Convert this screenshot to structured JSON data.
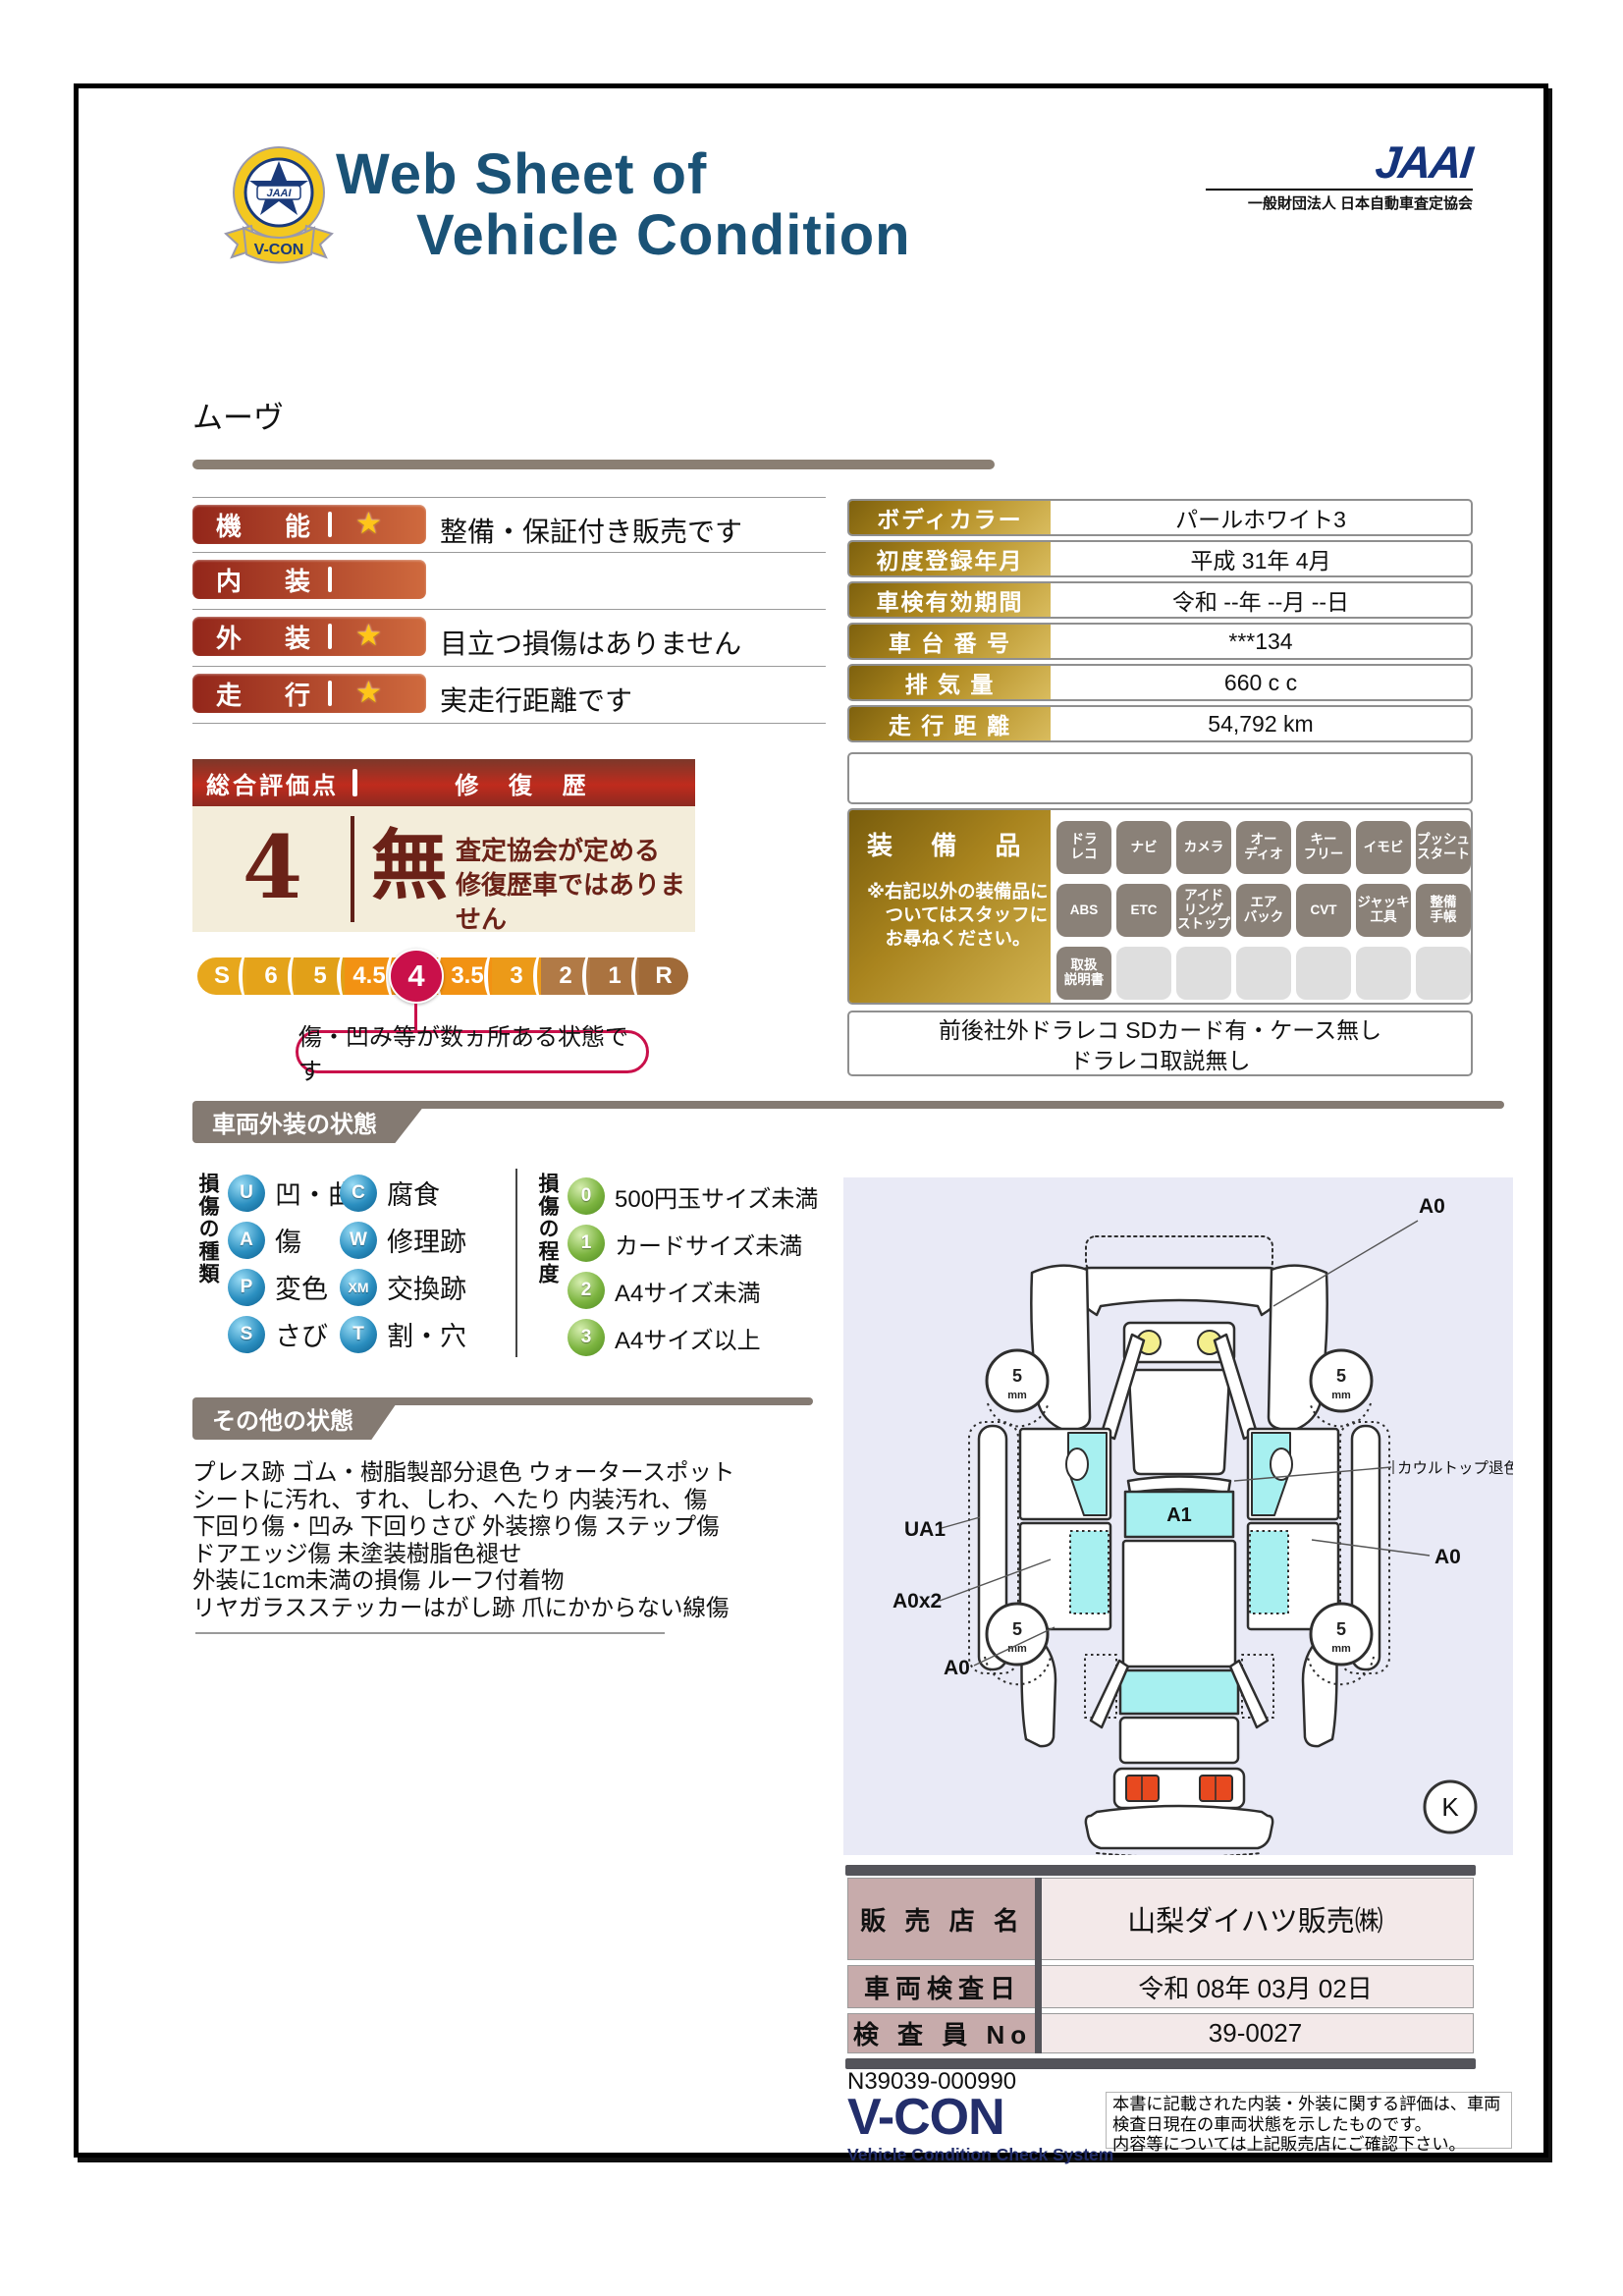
{
  "header": {
    "title_line1": "Web Sheet of",
    "title_line2": "Vehicle Condition",
    "emblem": {
      "badge_text": "JAAI",
      "ribbon_text": "V-CON"
    },
    "jaai_logo": "JAAI",
    "jaai_org": "一般財団法人 日本自動車査定協会"
  },
  "vehicle_name": "ムーヴ",
  "ratings": {
    "rows": [
      {
        "label": "機能",
        "star": true,
        "note": "整備・保証付き販売です"
      },
      {
        "label": "内装",
        "star": false,
        "note": ""
      },
      {
        "label": "外装",
        "star": true,
        "note": "目立つ損傷はありません"
      },
      {
        "label": "走行",
        "star": true,
        "note": "実走行距離です"
      }
    ]
  },
  "overall": {
    "score_header": "総合評価点",
    "repair_header": "修 復 歴",
    "score": "4",
    "repair_value": "無",
    "repair_note_line1": "査定協会が定める",
    "repair_note_line2": "修復歴車ではありません",
    "scale": [
      "S",
      "6",
      "5",
      "4.5",
      "4",
      "3.5",
      "3",
      "2",
      "1",
      "R"
    ],
    "scale_colors": [
      "#e7a71c",
      "#e4a31a",
      "#e1a018",
      "#f29213",
      "#ef9013",
      "#f29213",
      "#ec9a18",
      "#b17a46",
      "#aa7340",
      "#a06a38"
    ],
    "selected": "4",
    "bubble": "傷・凹み等が数ヵ所ある状態です"
  },
  "info_table": {
    "rows": [
      {
        "label": "ボディカラー",
        "value": "パールホワイト3"
      },
      {
        "label": "初度登録年月",
        "value": "平成 31年 4月"
      },
      {
        "label": "車検有効期間",
        "value": "令和 --年 --月 --日"
      },
      {
        "label": "車 台 番 号",
        "value": "***134"
      },
      {
        "label": "排  気  量",
        "value": "660 c c"
      },
      {
        "label": "走 行 距 離",
        "value": "54,792 km"
      }
    ]
  },
  "equipment": {
    "title": "装 備 品",
    "note_lines": [
      "※右記以外の装備品に",
      "　ついてはスタッフに",
      "　お尋ねください。"
    ],
    "badges": [
      [
        "ドラ",
        "レコ"
      ],
      [
        "ナビ"
      ],
      [
        "カメラ"
      ],
      [
        "オー",
        "ディオ"
      ],
      [
        "キー",
        "フリー"
      ],
      [
        "イモビ"
      ],
      [
        "プッシュ",
        "スタート"
      ],
      [
        "ABS"
      ],
      [
        "ETC"
      ],
      [
        "アイド",
        "リング",
        "ストップ"
      ],
      [
        "エア",
        "バック"
      ],
      [
        "CVT"
      ],
      [
        "ジャッキ",
        "工具"
      ],
      [
        "整備",
        "手帳"
      ],
      [
        "取扱",
        "説明書"
      ]
    ],
    "empty_count": 6,
    "notes": [
      "前後社外ドラレコ SDカード有・ケース無し",
      "ドラレコ取説無し"
    ]
  },
  "exterior_section": {
    "title": "車両外装の状態"
  },
  "damage_legend": {
    "kinds_title": "損傷の種類",
    "kinds": [
      {
        "code": "U",
        "label": "凹・曲"
      },
      {
        "code": "A",
        "label": "傷"
      },
      {
        "code": "P",
        "label": "変色"
      },
      {
        "code": "S",
        "label": "さび"
      },
      {
        "code": "C",
        "label": "腐食"
      },
      {
        "code": "W",
        "label": "修理跡"
      },
      {
        "code": "XM",
        "label": "交換跡"
      },
      {
        "code": "T",
        "label": "割・穴"
      }
    ],
    "degrees_title": "損傷の程度",
    "degrees": [
      {
        "code": "0",
        "label": "500円玉サイズ未満"
      },
      {
        "code": "1",
        "label": "カードサイズ未満"
      },
      {
        "code": "2",
        "label": "A4サイズ未満"
      },
      {
        "code": "3",
        "label": "A4サイズ以上"
      }
    ]
  },
  "other_section": {
    "title": "その他の状態",
    "lines": [
      "プレス跡 ゴム・樹脂製部分退色 ウォータースポット",
      "シートに汚れ、すれ、しわ、へたり 内装汚れ、傷",
      "下回り傷・凹み 下回りさび 外装擦り傷 ステップ傷",
      "ドアエッジ傷 未塗装樹脂色褪せ",
      "外装に1cm未満の損傷 ルーフ付着物",
      "リヤガラスステッカーはがし跡 爪にかからない線傷"
    ]
  },
  "diagram": {
    "a0_top": "A0",
    "cowl_label": "カウルトップ退色",
    "a1": "A1",
    "ua1": "UA1",
    "a0x2": "A0x2",
    "a0_left": "A0",
    "a0_right": "A0",
    "wheel_value": "5",
    "wheel_unit": "mm",
    "k_mark": "K"
  },
  "dealer_table": {
    "rows": [
      {
        "label": "販 売 店 名",
        "value": "山梨ダイハツ販売㈱"
      },
      {
        "label": "車両検査日",
        "value": "令和 08年 03月 02日"
      },
      {
        "label": "検 査 員 No",
        "value": "39-0027"
      }
    ]
  },
  "footer": {
    "serial": "N39039-000990",
    "vcon": "V-CON",
    "vcon_sub": "Vehicle Condition Check System",
    "disclaimer_lines": [
      "本書に記載された内装・外装に関する評価は、車両",
      "検査日現在の車両状態を示したものです。",
      "内容等については上記販売店にご確認下さい。"
    ]
  },
  "colors": {
    "title_blue": "#1a5276",
    "maroon_text": "#6b2218",
    "crimson_accent": "#c9104a",
    "gold": "#b08a20",
    "navy_logo": "#232e6b"
  }
}
